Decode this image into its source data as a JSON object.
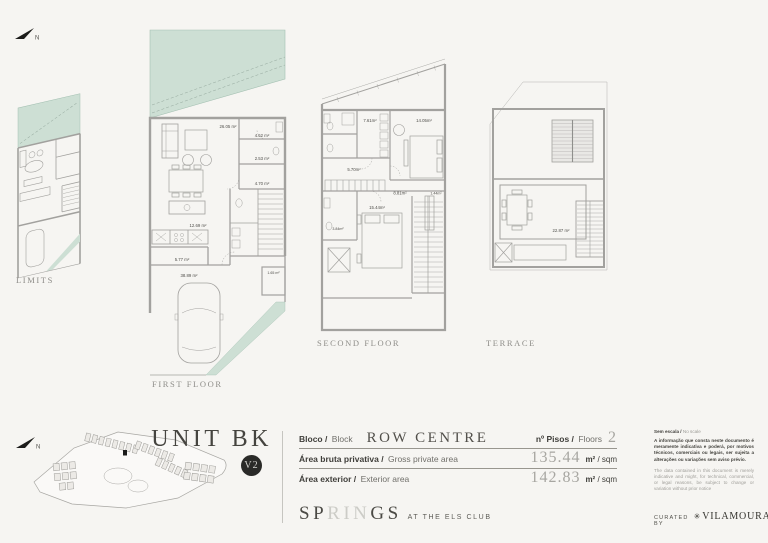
{
  "page": {
    "bg": "#f6f5f2",
    "accent_green": "#cddfd4",
    "badge_dark": "#2a2a28"
  },
  "compass": {
    "label": "N"
  },
  "plans": {
    "limits": {
      "label": "LIMITS"
    },
    "first_floor": {
      "label": "FIRST FLOOR",
      "areas": {
        "living": "26.05 m²",
        "bath": "4.62 m²",
        "wc": "2.53 m²",
        "hall": "4.70 m²",
        "kitchen": "12.69 m²",
        "entry": "5.77 m²",
        "driveway": "38.89 m²",
        "storage": "1.65 m²"
      }
    },
    "second_floor": {
      "label": "SECOND FLOOR",
      "areas": {
        "laundry": "7.61m²",
        "bedroom1": "14.05m²",
        "hall": "5.70m²",
        "corridor": "8.81m²",
        "closet": "1.44m²",
        "bedroom2": "15.44m²",
        "bath": "3.84m²"
      }
    },
    "terrace": {
      "label": "TERRACE",
      "areas": {
        "terrace": "22.87 m²"
      }
    }
  },
  "footer": {
    "unit_title": "UNIT BK",
    "version_badge": "V2",
    "table": {
      "block_label_pt": "Bloco /",
      "block_label_en": "Block",
      "block_value": "ROW CENTRE",
      "floors_label_pt": "nº Pisos /",
      "floors_label_en": "Floors",
      "floors_value": "2",
      "gross_label_pt": "Área bruta privativa /",
      "gross_label_en": "Gross private area",
      "gross_value": "135.44",
      "exterior_label_pt": "Área exterior /",
      "exterior_label_en": "Exterior area",
      "exterior_value": "142.83",
      "unit_m2": "m²",
      "unit_rest": " / sqm"
    },
    "brand": {
      "part1": "SP",
      "part2": "RIN",
      "part3": "GS",
      "tagline": "AT THE ELS CLUB"
    },
    "disclaimer": {
      "scale_pt": "Sem escala /",
      "scale_en": " No scale",
      "text_pt": "A informação que consta neste documento é meramente indicativa e poderá, por motivos técnicos, comerciais ou legais, ser sujeita a alterações ou variações sem aviso prévio.",
      "text_en": "The data contained in this document is merely indicative and might, for technical, commercial, or legal reasons, be subject to change or variation without prior notice",
      "curated_by": "CURATED BY",
      "curated_icon": "✳",
      "curated_brand": "VILAMOURA"
    }
  }
}
